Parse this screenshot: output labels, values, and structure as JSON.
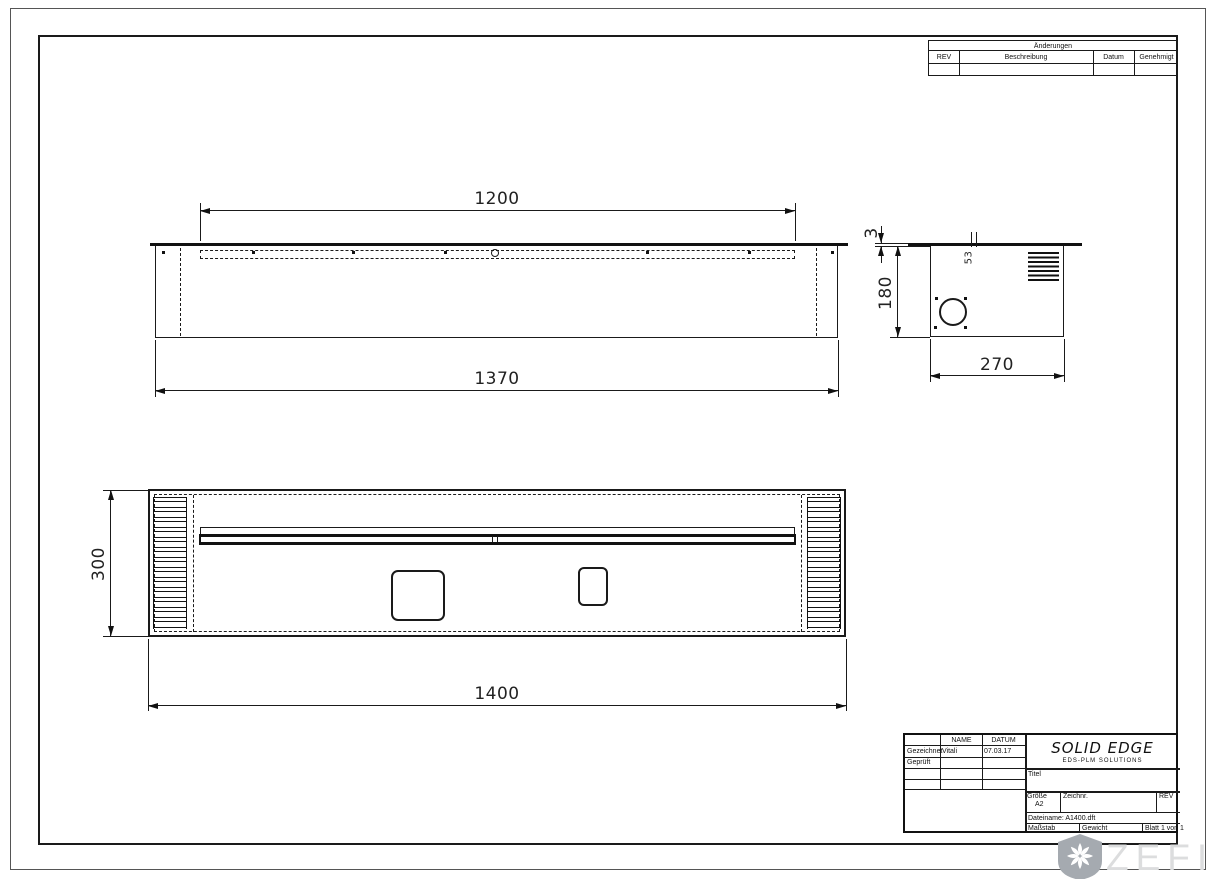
{
  "revision": {
    "title": "Änderungen",
    "columns": [
      "REV",
      "Beschreibung",
      "Datum",
      "Genehmigt"
    ]
  },
  "title_block": {
    "name_header": "NAME",
    "date_header": "DATUM",
    "drawn_label": "Gezeichnet",
    "drawn_name": "Vitali",
    "drawn_date": "07.03.17",
    "checked_label": "Geprüft",
    "logo": "SOLID EDGE",
    "logo_sub": "EDS-PLM SOLUTIONS",
    "title_label": "Titel",
    "size_label": "Größe",
    "size_value": "A2",
    "drawing_no_label": "Zeichnr.",
    "rev_label": "REV",
    "filename": "Dateiname: A1400.dft",
    "scale_label": "Maßstab",
    "weight_label": "Gewicht",
    "sheet_label": "Blatt 1 von 1"
  },
  "views": {
    "front": {
      "dim_top": "1200",
      "dim_bottom": "1370"
    },
    "side": {
      "dim_flange": "3",
      "dim_height": "180",
      "dim_width": "270",
      "dim_slot": "53"
    },
    "plan": {
      "dim_height": "300",
      "dim_width": "1400"
    }
  },
  "watermark": {
    "text": "ZEFIRE"
  }
}
